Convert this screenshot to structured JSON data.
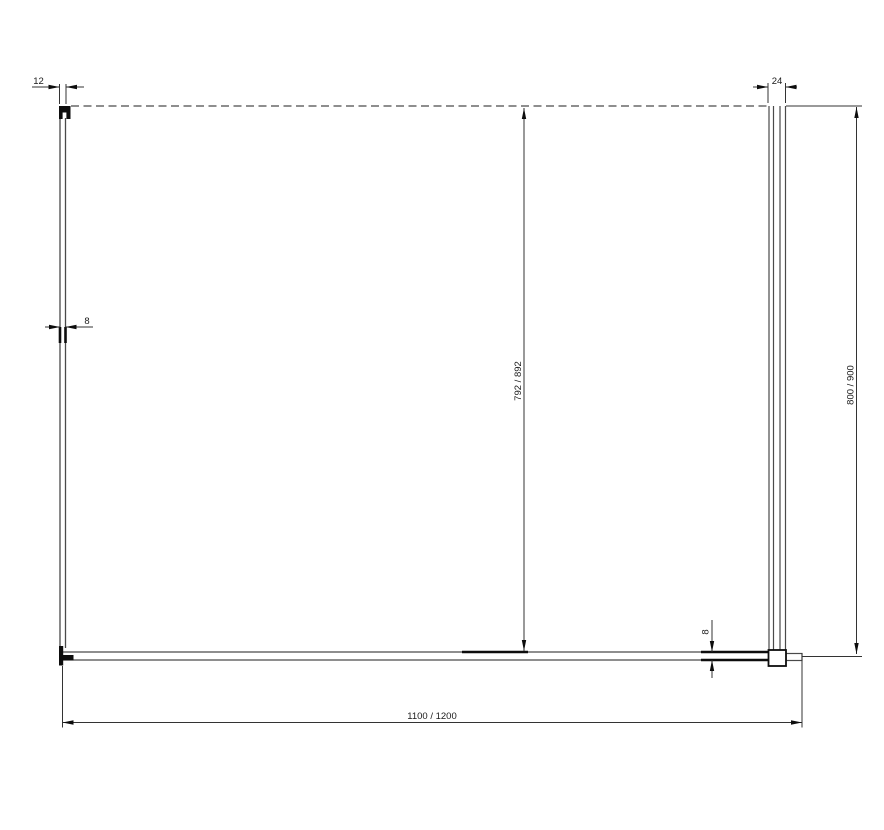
{
  "drawing": {
    "labels": {
      "wall_profile_width": "12",
      "support_profile_width": "24",
      "side_glass_thickness": "8",
      "front_glass_thickness": "8",
      "glass_height": "792 / 892",
      "overall_height": "800 / 900",
      "overall_width": "1100 / 1200"
    },
    "colors": {
      "thin_line": "#4a4a4a",
      "dimension_line": "#333333",
      "solid_black": "#0d0d0d",
      "background": "#ffffff"
    }
  }
}
